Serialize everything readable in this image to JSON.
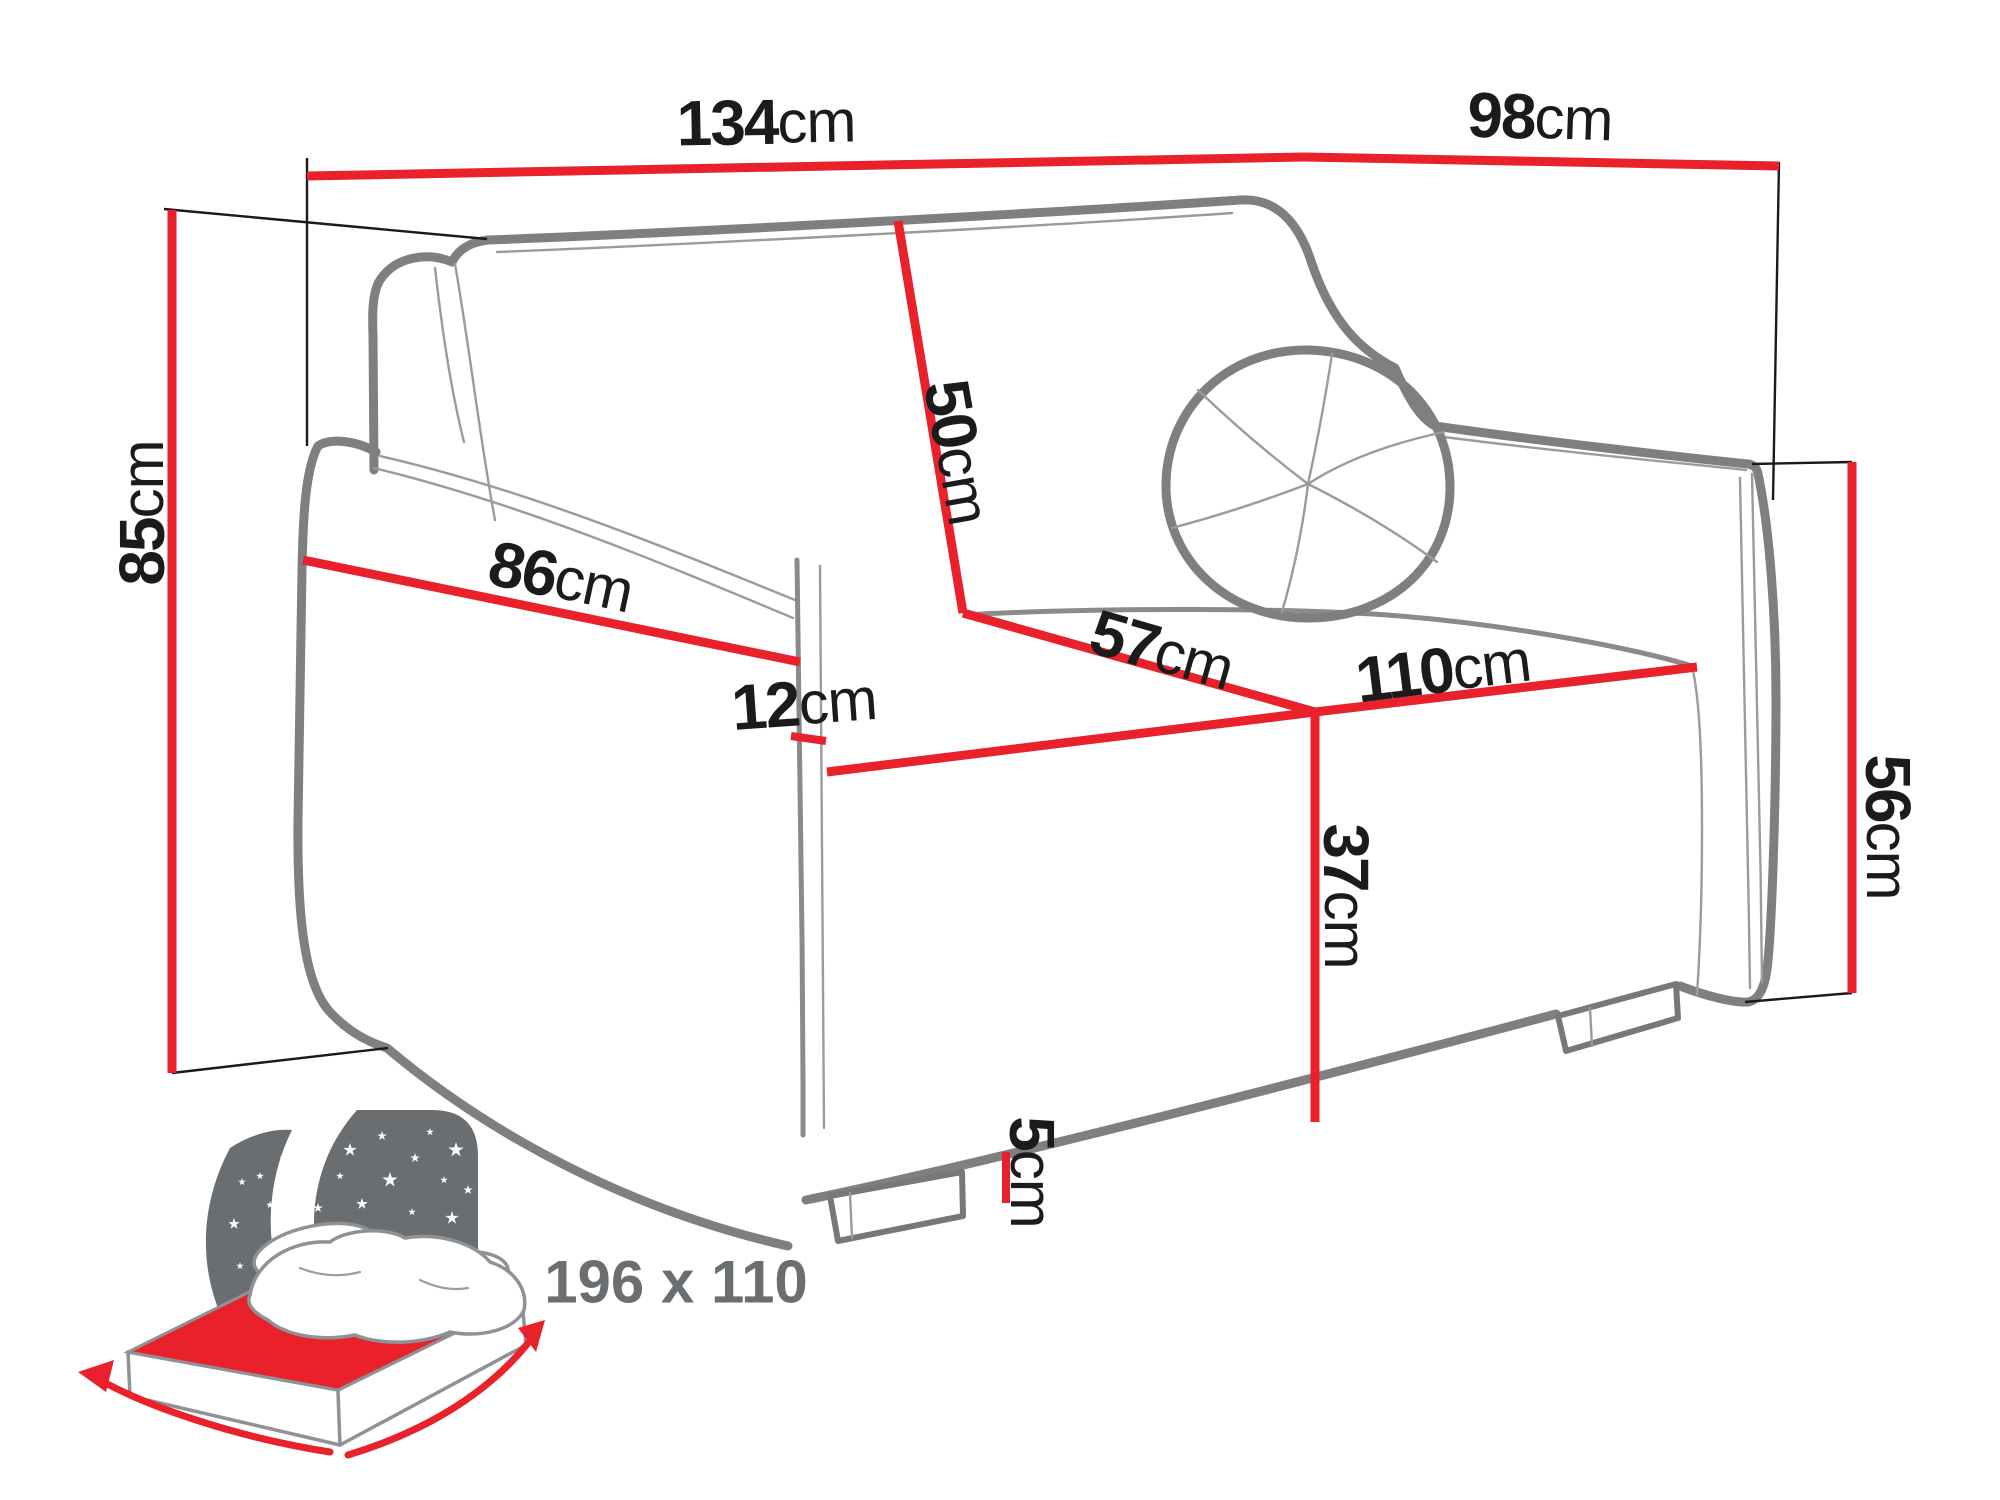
{
  "diagram": {
    "kind": "sofa-bed dimension drawing",
    "colors": {
      "dimension_line": "#e8212b",
      "sofa_outline": "#7f7f7f",
      "label_text": "#1b1b1b",
      "icon_gray": "#6b6e70"
    },
    "dims": {
      "total_width": {
        "value": "134",
        "unit": "cm"
      },
      "total_depth": {
        "value": "98",
        "unit": "cm"
      },
      "total_height": {
        "value": "85",
        "unit": "cm"
      },
      "backrest_height": {
        "value": "50",
        "unit": "cm"
      },
      "armrest_length": {
        "value": "86",
        "unit": "cm"
      },
      "armrest_width": {
        "value": "12",
        "unit": "cm"
      },
      "seat_depth": {
        "value": "57",
        "unit": "cm"
      },
      "seat_width": {
        "value": "110",
        "unit": "cm"
      },
      "seat_height": {
        "value": "37",
        "unit": "cm"
      },
      "leg_height": {
        "value": "5",
        "unit": "cm"
      },
      "armrest_height": {
        "value": "56",
        "unit": "cm"
      }
    },
    "sleeping_area": {
      "label": "196 x 110"
    }
  }
}
